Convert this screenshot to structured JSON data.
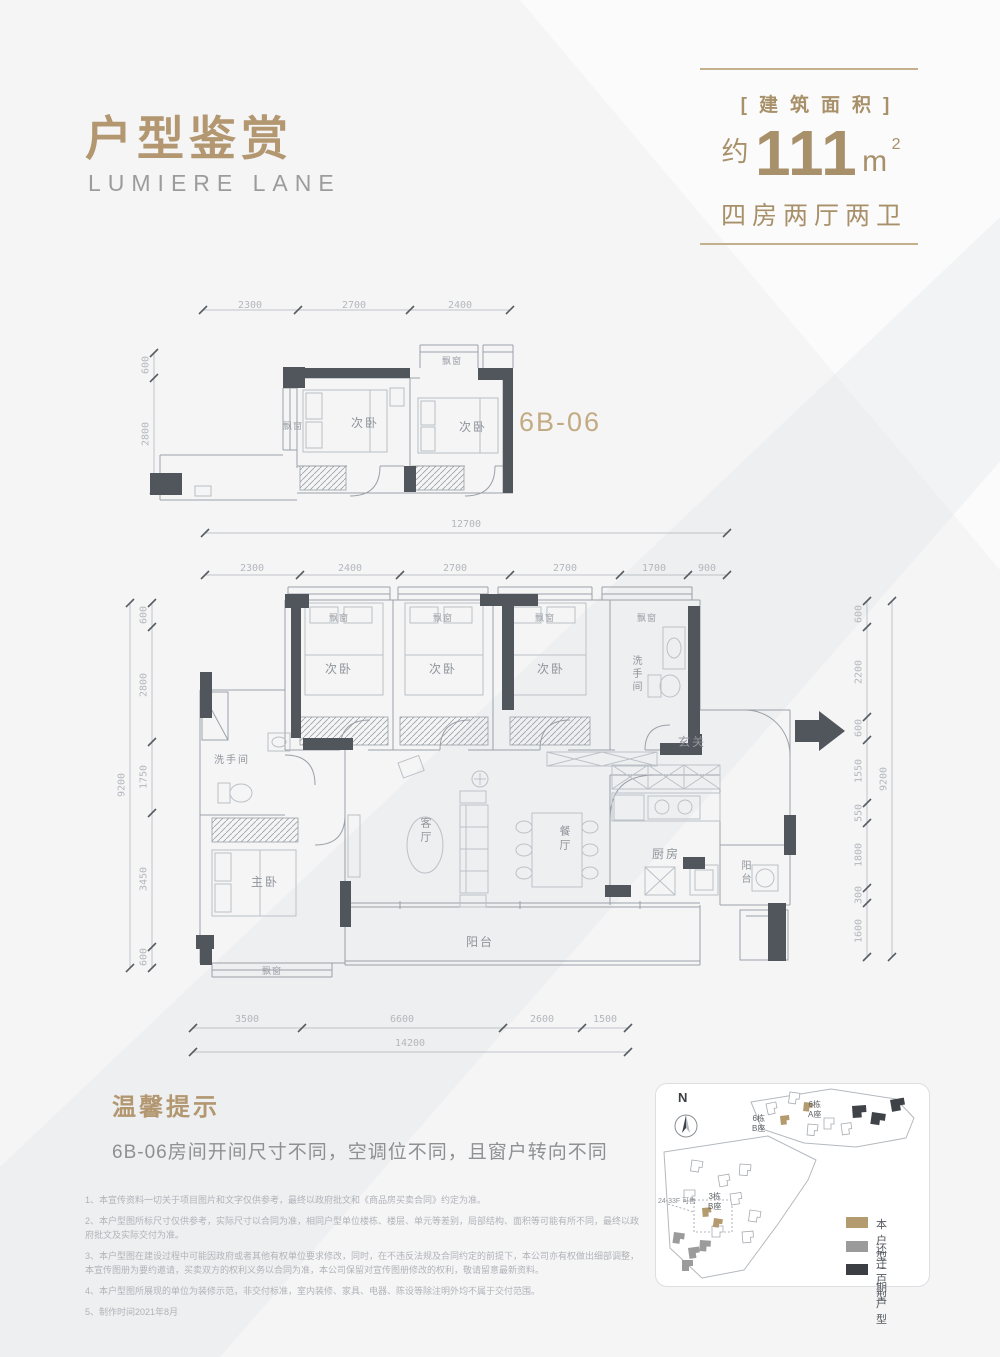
{
  "header": {
    "title": "户型鉴赏",
    "subtitle": "LUMIERE LANE"
  },
  "area_box": {
    "bracket": "[建筑面积]",
    "approx": "约",
    "value": "111",
    "unit": "m",
    "sup": "2",
    "layout": "四房两厅两卫"
  },
  "labels": {
    "unit_code": "6B-06",
    "bedroom": "次卧",
    "master": "主卧",
    "living": "客厅",
    "dining": "餐厅",
    "kitchen": "厨房",
    "balcony": "阳台",
    "bay_window": "飘窗",
    "bathroom": "洗手间",
    "entry": "玄关"
  },
  "small_plan": {
    "dims_top": [
      "2300",
      "2700",
      "2400"
    ],
    "dims_left": [
      "600",
      "2800"
    ]
  },
  "main_plan": {
    "dim_top_total": "12700",
    "dims_top": [
      "2300",
      "2400",
      "2700",
      "2700",
      "1700",
      "900"
    ],
    "dims_left": [
      "600",
      "2800",
      "1750",
      "3450",
      "600"
    ],
    "dim_left_total": "9200",
    "dims_right": [
      "600",
      "2200",
      "600",
      "1550",
      "550",
      "1800",
      "300",
      "1600"
    ],
    "dim_right_total": "9200",
    "dims_bottom": [
      "3500",
      "6600",
      "2600",
      "1500"
    ],
    "dim_bottom_total": "14200"
  },
  "tips": {
    "heading": "温馨提示",
    "body": "6B-06房间开间尺寸不同，空调位不同，且窗户转向不同"
  },
  "notes": [
    "1、本宣传资料一切关于项目图片和文字仅供参考，最终以政府批文和《商品房买卖合同》约定为准。",
    "2、本户型图所标尺寸仅供参考，实际尺寸以合同为准，相同户型单位楼栋、楼层、单元等差别，局部结构、面积等可能有所不同，最终以政府批文及实际交付为准。",
    "3、本户型图在建设过程中可能因政府或者其他有权单位要求修改，同时，在不违反法规及合同约定的前提下，本公司亦有权做出细部调整，本宣传图册为要约邀请，买卖双方的权利义务以合同为准，本公司保留对宣传图册修改的权利，敬请留意最新资料。",
    "4、本户型图所展现的单位为装修示范，非交付标准，室内装修、家具、电器、陈设等除注明外均不属于交付范围。",
    "5、制作时间2021年8月"
  ],
  "site_map": {
    "north": "N",
    "b6b_1": "6栋",
    "b6b_2": "B座",
    "b6a_1": "6栋",
    "b6a_2": "A座",
    "b3b_1": "3栋",
    "b3b_2": "B座",
    "sale_note": "24-33F 可售",
    "legend": [
      {
        "label": "本户型",
        "color": "#b49b6f"
      },
      {
        "label": "还迁户型",
        "color": "#9b9b9b"
      },
      {
        "label": "二期户型",
        "color": "#3b3e42"
      }
    ]
  }
}
